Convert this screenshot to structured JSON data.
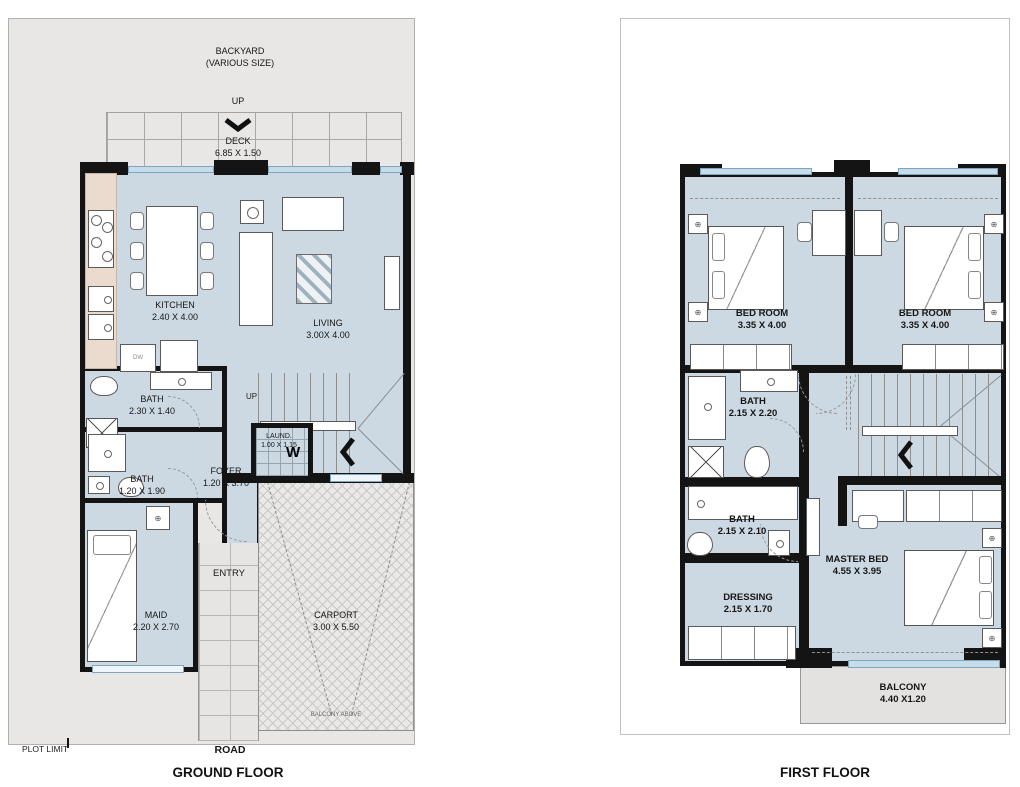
{
  "titles": {
    "ground": "GROUND FLOOR",
    "first": "FIRST FLOOR"
  },
  "site": {
    "backyard_name": "BACKYARD",
    "backyard_note": "(VARIOUS SIZE)",
    "road": "ROAD",
    "plot_limit": "PLOT LIMIT",
    "balcony_above_note": "BALCONY ABOVE"
  },
  "colors": {
    "wall": "#141414",
    "room_fill": "#ccd9e3",
    "plot_fill": "#e8e7e5",
    "counter_fill": "#eadbce",
    "window_fill": "#c5dcea",
    "balcony_fill": "#e3e2e0"
  },
  "ground": {
    "deck": {
      "name": "DECK",
      "dims": "6.85 X 1.50",
      "up": "UP"
    },
    "kitchen": {
      "name": "KITCHEN",
      "dims": "2.40 X 4.00"
    },
    "living": {
      "name": "LIVING",
      "dims": "3.00X 4.00"
    },
    "bath_a": {
      "name": "BATH",
      "dims": "2.30 X 1.40"
    },
    "bath_b": {
      "name": "BATH",
      "dims": "1.20 X 1.90"
    },
    "foyer": {
      "name": "FOYER",
      "dims": "1.20 X 3.70"
    },
    "laundry": {
      "name": "LAUND.",
      "dims": "1.00 X 1.15",
      "washer": "W"
    },
    "maid": {
      "name": "MAID",
      "dims": "2.20 X 2.70"
    },
    "entry": {
      "name": "ENTRY"
    },
    "carport": {
      "name": "CARPORT",
      "dims": "3.00 X 5.50"
    },
    "stairs": {
      "up": "UP"
    },
    "appliances": {
      "dishwasher": "DW"
    }
  },
  "first": {
    "bedroom_left": {
      "name": "BED ROOM",
      "dims": "3.35 X 4.00"
    },
    "bedroom_right": {
      "name": "BED ROOM",
      "dims": "3.35 X 4.00"
    },
    "bath_a": {
      "name": "BATH",
      "dims": "2.15 X 2.20"
    },
    "bath_b": {
      "name": "BATH",
      "dims": "2.15 X 2.10"
    },
    "dressing": {
      "name": "DRESSING",
      "dims": "2.15 X 1.70"
    },
    "master": {
      "name": "MASTER BED",
      "dims": "4.55 X 3.95"
    },
    "balcony": {
      "name": "BALCONY",
      "dims": "4.40 X1.20"
    }
  }
}
